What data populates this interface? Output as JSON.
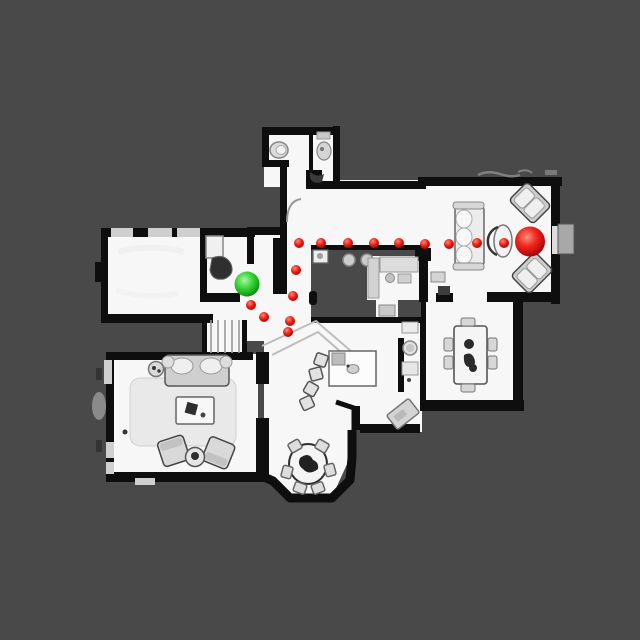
{
  "scene": {
    "type": "top-down floor plan scan with navigation path",
    "background_color": "#494949",
    "floor_color": "#f7f7f7",
    "wall_color": "#0e0e0e",
    "furniture_color": "#d9d9d9",
    "window_color": "#cfcfcf"
  },
  "markers": {
    "start": {
      "label": "start",
      "color": "#2fd02f",
      "x": 247,
      "y": 284,
      "r": 12.5
    },
    "goal": {
      "label": "goal",
      "color": "#e61515",
      "x": 530,
      "y": 241.5,
      "r": 15
    },
    "waypoint": {
      "color": "#e01212",
      "r": 5
    },
    "waypoints": [
      [
        299,
        243
      ],
      [
        321,
        243
      ],
      [
        348,
        243
      ],
      [
        374,
        243
      ],
      [
        399,
        243
      ],
      [
        425,
        244
      ],
      [
        449,
        244
      ],
      [
        477,
        243
      ],
      [
        504,
        243
      ],
      [
        296,
        270
      ],
      [
        293,
        296
      ],
      [
        251,
        305
      ],
      [
        264,
        317
      ],
      [
        290,
        321
      ],
      [
        288,
        332
      ]
    ]
  }
}
